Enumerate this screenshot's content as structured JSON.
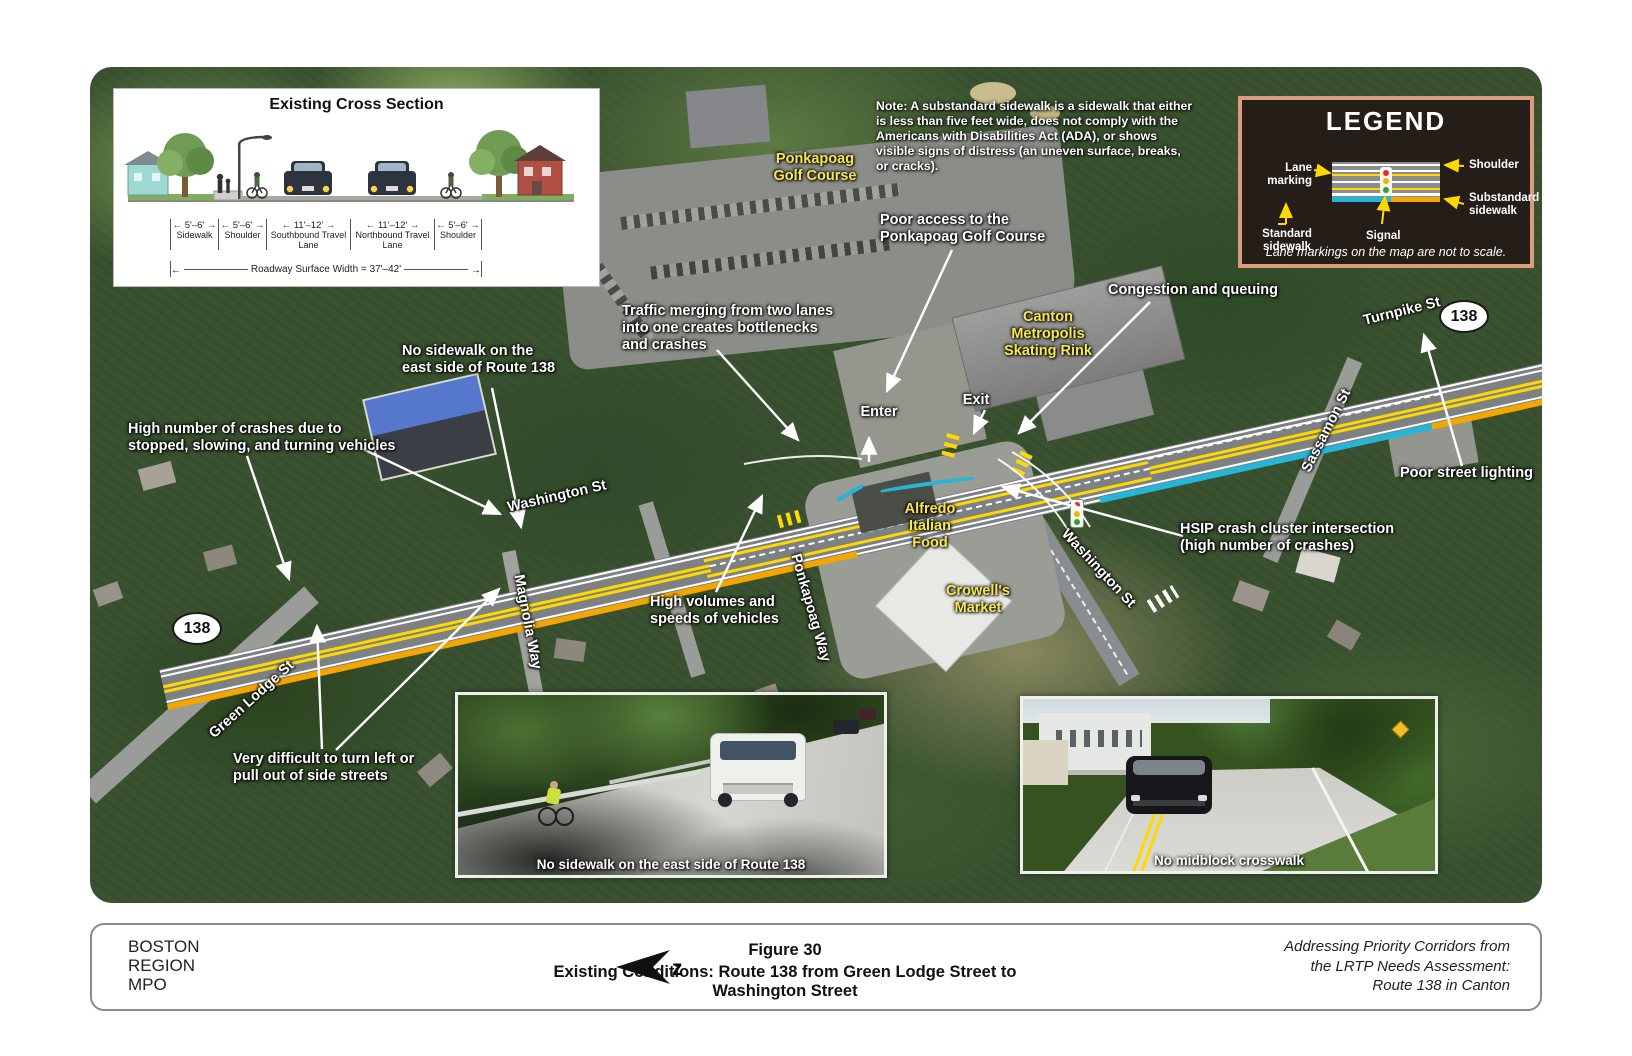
{
  "theme": {
    "lane_yellow": "#ffd800",
    "substandard_orange": "#f5a500",
    "standard_cyan": "#25b5d8",
    "label_yellow": "#f9e84b",
    "road_gray": "#7d8184",
    "legend_bg": "#251d17",
    "legend_border": "#d99c7c"
  },
  "cross_section": {
    "title": "Existing Cross Section",
    "segments": [
      {
        "width": "5'–6'",
        "label": "Sidewalk"
      },
      {
        "width": "5'–6'",
        "label": "Shoulder"
      },
      {
        "width": "11'–12'",
        "label": "Southbound Travel Lane"
      },
      {
        "width": "11'–12'",
        "label": "Northbound Travel Lane"
      },
      {
        "width": "5'–6'",
        "label": "Shoulder"
      }
    ],
    "total_width": "Roadway Surface Width = 37'–42'"
  },
  "note": "Note: A substandard sidewalk is a sidewalk that either is less than five feet wide, does not comply with the Americans with Disabilities Act (ADA), or shows visible signs of distress (an uneven surface, breaks, or cracks).",
  "legend": {
    "title": "LEGEND",
    "labels": {
      "shoulder": "Shoulder",
      "substandard_sidewalk": "Substandard\nsidewalk",
      "lane_marking": "Lane marking",
      "standard_sidewalk": "Standard\nsidewalk",
      "signal": "Signal"
    },
    "footnote": "Lane markings on the map are not to scale."
  },
  "map": {
    "route_shield": "138",
    "streets": {
      "washington_west": "Washington St",
      "washington_south": "Washington St",
      "turnpike": "Turnpike St",
      "sassamon": "Sassamon St",
      "magnolia": "Magnolia Way",
      "green_lodge": "Green Lodge St",
      "ponkapoag_way": "Ponkapoag Way"
    },
    "places": {
      "golf_course": "Ponkapoag\nGolf Course",
      "skating_rink": "Canton\nMetropolis\nSkating Rink",
      "alfredo": "Alfredo\nItalian\nFood",
      "crowells": "Crowell's\nMarket"
    },
    "annotations": {
      "no_sidewalk_top": "No sidewalk on the\neast side of Route 138",
      "high_crashes": "High number of crashes due to\nstopped, slowing, and turning vehicles",
      "traffic_merging": "Traffic merging from two lanes\ninto one creates bottlenecks\nand crashes",
      "poor_access": "Poor access to the\nPonkapoag Golf Course",
      "congestion": "Congestion and queuing",
      "enter": "Enter",
      "exit": "Exit",
      "poor_lighting": "Poor street lighting",
      "hsip": "HSIP crash cluster intersection\n(high number of crashes)",
      "high_volumes": "High volumes and\nspeeds of vehicles",
      "very_difficult": "Very difficult to turn left or\npull out of side streets"
    }
  },
  "photos": {
    "left_caption": "No sidewalk on the east side of Route 138",
    "right_caption": "No midblock crosswalk"
  },
  "footer": {
    "agency_lines": "BOSTON\nREGION\nMPO",
    "figure_number": "Figure 30",
    "figure_title": "Existing Conditions: Route 138 from Green Lodge Street to Washington Street",
    "project_lines": "Addressing Priority Corridors from\nthe LRTP Needs Assessment:\nRoute 138 in Canton",
    "north_glyph": "z"
  }
}
